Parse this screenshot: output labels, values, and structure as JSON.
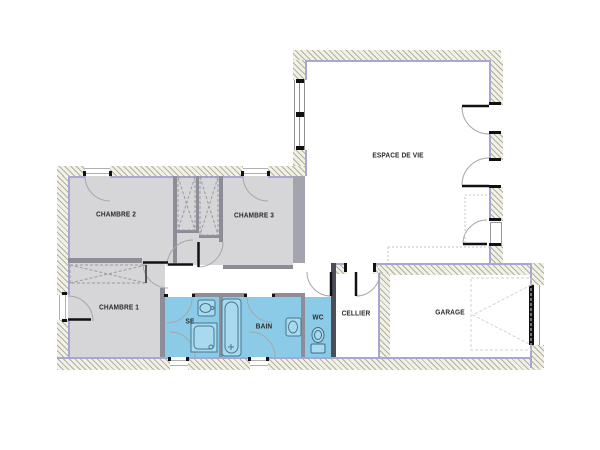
{
  "plan": {
    "type": "floor-plan",
    "rooms": [
      {
        "id": "espace-de-vie",
        "label": "ESPACE DE VIE"
      },
      {
        "id": "chambre-2",
        "label": "CHAMBRE 2"
      },
      {
        "id": "chambre-3",
        "label": "CHAMBRE 3"
      },
      {
        "id": "chambre-1",
        "label": "CHAMBRE 1"
      },
      {
        "id": "se",
        "label": "SE"
      },
      {
        "id": "bain",
        "label": "BAIN"
      },
      {
        "id": "wc",
        "label": "WC"
      },
      {
        "id": "cellier",
        "label": "CELLIER"
      },
      {
        "id": "garage",
        "label": "GARAGE"
      }
    ],
    "icons": [
      "door-arc-icon",
      "window-icon",
      "closet-cross-icon",
      "bathtub-icon",
      "shower-icon",
      "washbasin-icon",
      "toilet-icon",
      "garage-door-icon",
      "kitchen-counter-icon"
    ],
    "colors": {
      "bedroom_fill": "#d6d6d8",
      "wet_room_fill": "#8ccbe7",
      "wall_hatch": "#b2b19b",
      "insulation_line": "#a8a6d2",
      "partition": "#8d8d97",
      "fixture_stroke": "#47768e",
      "door_leaf": "#1a1a1a"
    }
  }
}
